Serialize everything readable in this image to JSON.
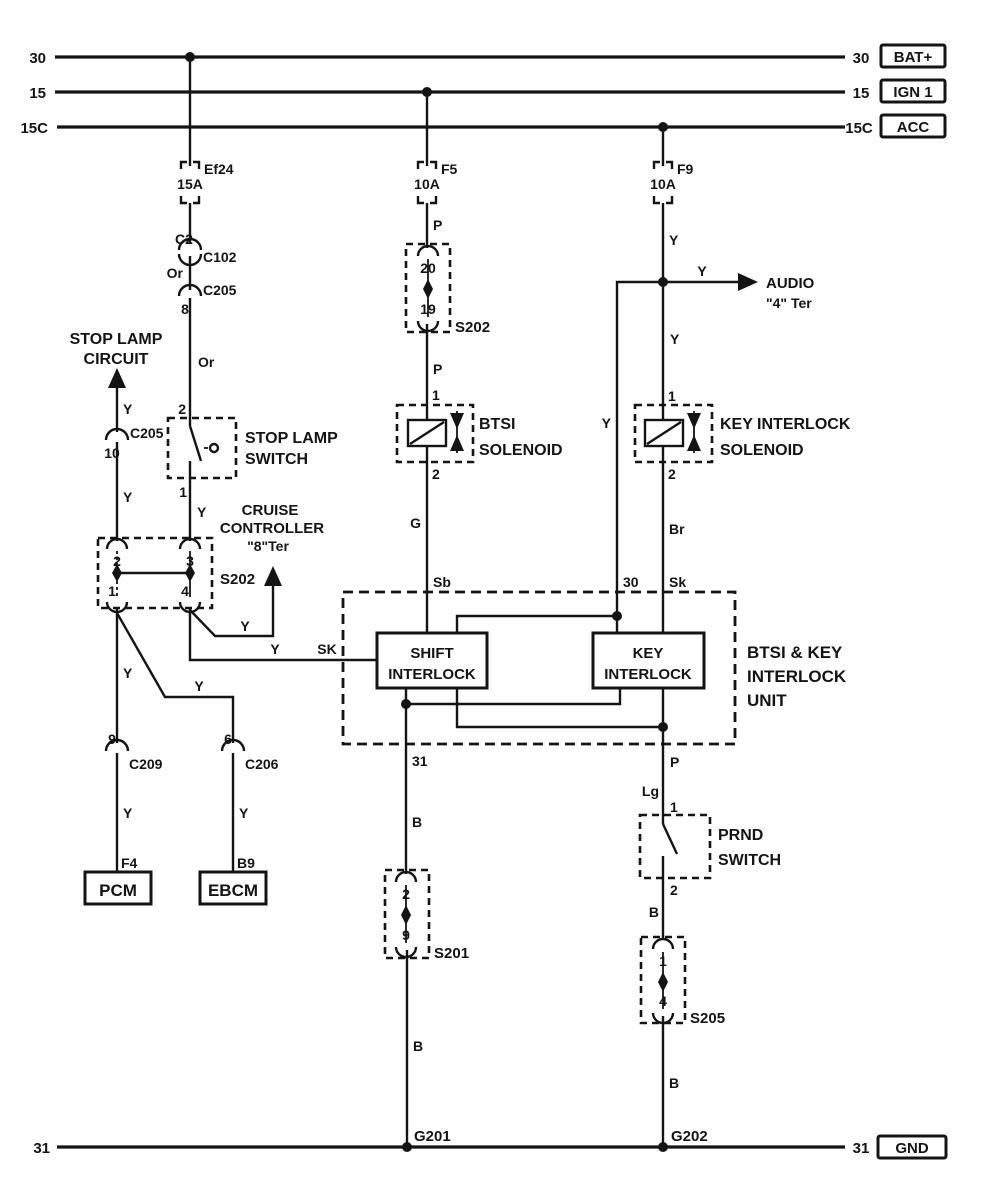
{
  "buses": {
    "bat": {
      "left": "30",
      "right": "30",
      "tag": "BAT+"
    },
    "ign1": {
      "left": "15",
      "right": "15",
      "tag": "IGN 1"
    },
    "acc": {
      "left": "15C",
      "right": "15C",
      "tag": "ACC"
    },
    "gnd": {
      "left": "31",
      "right": "31",
      "tag": "GND"
    }
  },
  "fuses": {
    "ef24": {
      "name": "Ef24",
      "rating": "15A"
    },
    "f5": {
      "name": "F5",
      "rating": "10A"
    },
    "f9": {
      "name": "F9",
      "rating": "10A"
    }
  },
  "stop_lamp_feed": {
    "c2": "C2",
    "c102": "C102",
    "wire_or_1": "Or",
    "c205": "C205",
    "pin8": "8",
    "wire_or_2": "Or",
    "pin_top": "2",
    "switch_name_1": "STOP LAMP",
    "switch_name_2": "SWITCH",
    "pin_bottom": "1",
    "wire_y": "Y"
  },
  "stop_lamp_circuit": {
    "name_1": "STOP LAMP",
    "name_2": "CIRCUIT",
    "wire_y_top": "Y",
    "c205": "C205",
    "pin10": "10",
    "wire_y_bottom": "Y"
  },
  "splice_s202_left": {
    "pin2": "2",
    "pin3": "3",
    "pin1": "1",
    "pin4": "4",
    "name": "S202"
  },
  "cruise": {
    "name_1": "CRUISE",
    "name_2": "CONTROLLER",
    "name_3": "\"8\"Ter",
    "wire_y": "Y"
  },
  "pcm_branch": {
    "wire_y_1": "Y",
    "pin9": "9",
    "c209": "C209",
    "wire_y_2": "Y",
    "pin_f4": "F4",
    "box": "PCM"
  },
  "ebcm_branch": {
    "wire_y_1": "Y",
    "pin6": "6",
    "c206": "C206",
    "wire_y_2": "Y",
    "pin_b9": "B9",
    "box": "EBCM"
  },
  "shift_feed": {
    "wire_y": "Y",
    "wire_sk": "SK"
  },
  "btsi_feed": {
    "wire_p_1": "P",
    "splice": {
      "pin20": "20",
      "pin19": "19",
      "name": "S202"
    },
    "wire_p_2": "P",
    "pin1": "1",
    "name_1": "BTSI",
    "name_2": "SOLENOID",
    "pin2": "2",
    "wire_g": "G",
    "wire_sb": "Sb"
  },
  "key_feed": {
    "wire_y_1": "Y",
    "audio": {
      "wire_y": "Y",
      "name": "AUDIO",
      "terminal": "\"4\" Ter"
    },
    "branch_wire_y": "Y",
    "branch_pin30": "30",
    "wire_y_2": "Y",
    "pin1": "1",
    "name_1": "KEY INTERLOCK",
    "name_2": "SOLENOID",
    "pin2": "2",
    "wire_br": "Br",
    "wire_sk": "Sk"
  },
  "unit": {
    "shift_1": "SHIFT",
    "shift_2": "INTERLOCK",
    "key_1": "KEY",
    "key_2": "INTERLOCK",
    "name_1": "BTSI & KEY",
    "name_2": "INTERLOCK",
    "name_3": "UNIT",
    "pin31": "31",
    "pin_p": "P"
  },
  "ground_left": {
    "wire_b_1": "B",
    "splice": {
      "pin2": "2",
      "pin9": "9",
      "name": "S201"
    },
    "wire_b_2": "B",
    "ground": "G201"
  },
  "prnd": {
    "wire_lg": "Lg",
    "pin1": "1",
    "name_1": "PRND",
    "name_2": "SWITCH",
    "pin2": "2",
    "wire_b": "B"
  },
  "ground_right": {
    "splice": {
      "pin1": "1",
      "pin4": "4",
      "name": "S205"
    },
    "wire_b": "B",
    "ground": "G202"
  }
}
